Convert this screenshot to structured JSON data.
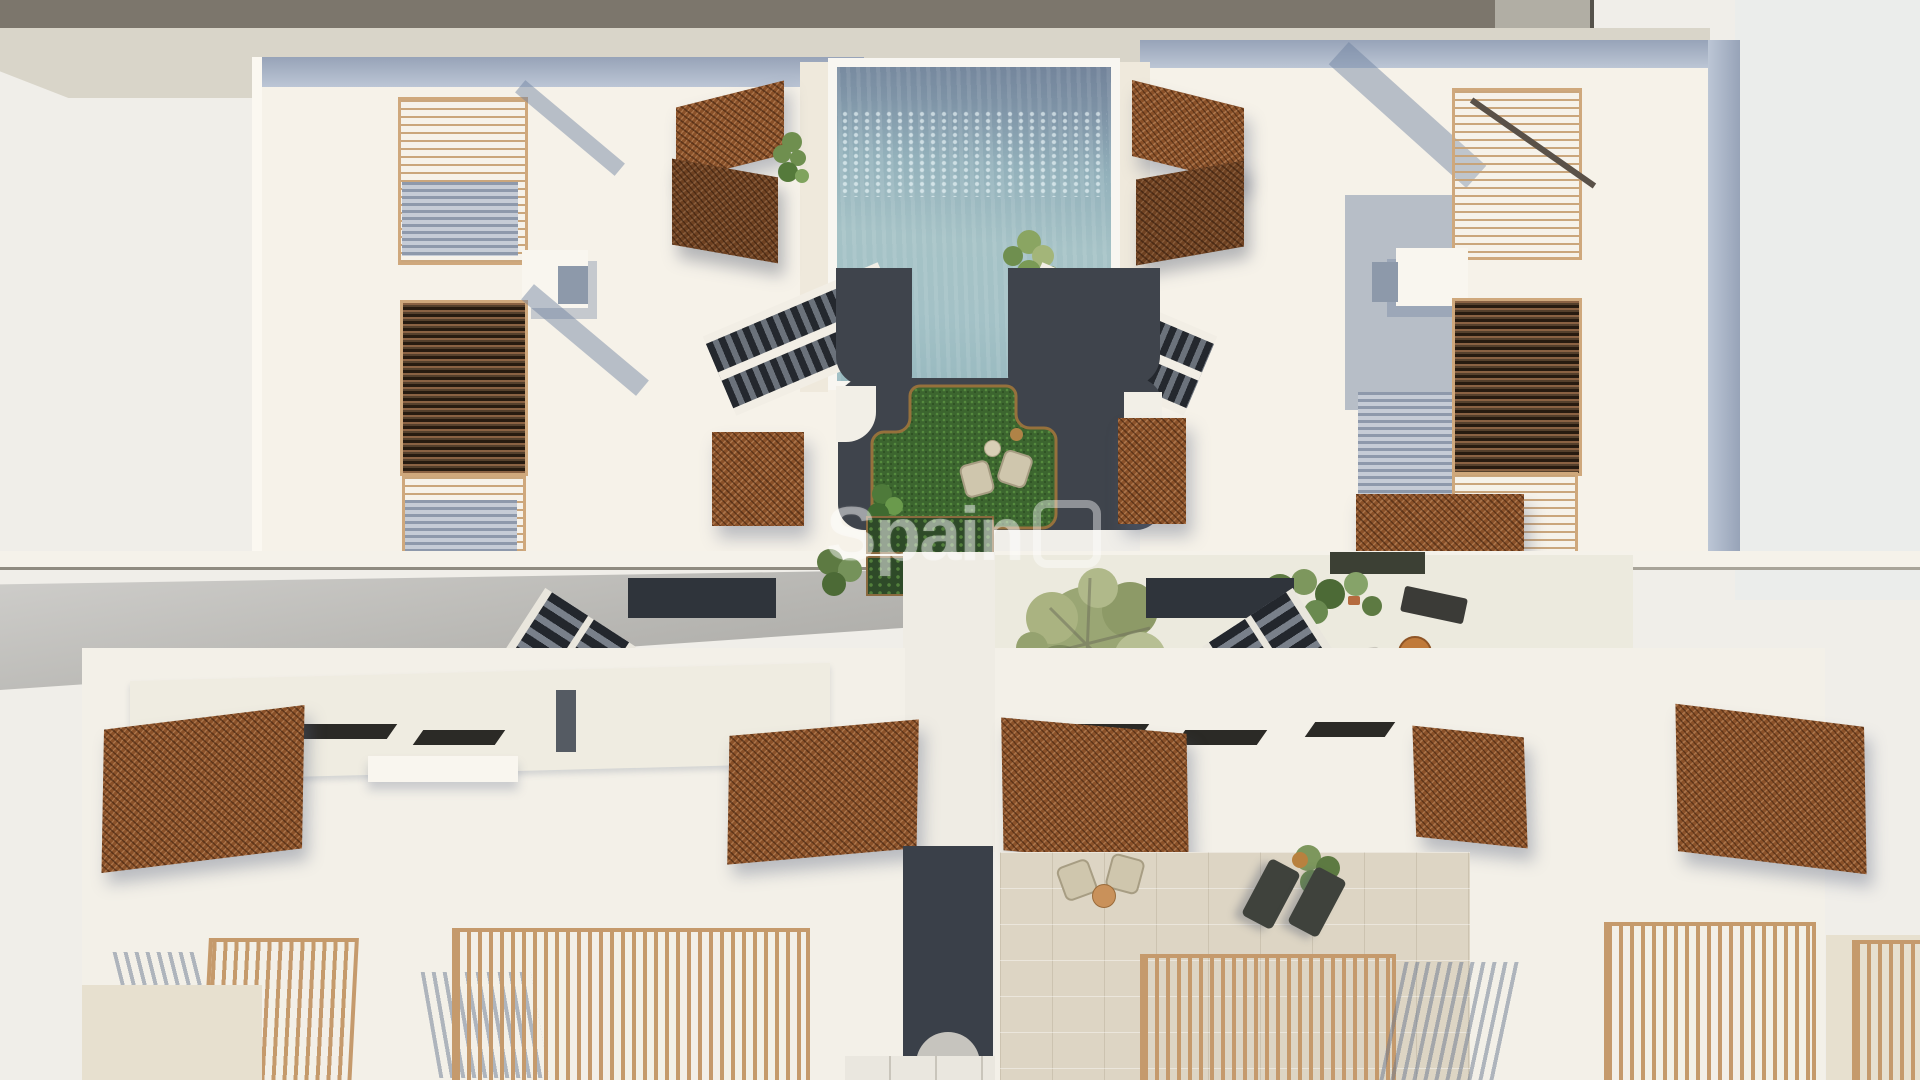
{
  "image": {
    "type": "architectural-aerial-render",
    "subject": "Top-down 3D render of a residential complex: two upper apartment blocks with slatted pergolas flanking a swimming pool, a sunken charcoal courtyard with a grass lounge area, twin stair ramps, a lower row of white-roofed townhouses with corten mesh canopies, wooden-slat terrace railings, olive tree and planted terraces, and a central dark walkway"
  },
  "watermark": {
    "text": "Spain",
    "color": "#ffffff",
    "opacity": "0.42"
  },
  "palette": {
    "background": "#f0eee9",
    "top_strip": "#7c766c",
    "sand_band": "#d9d5c9",
    "roof_cream": "#f6f2e9",
    "parapet_blue_gray": "#a9b3c4",
    "pool_deep": "#72839a",
    "pool_shallow": "#a5c2c6",
    "courtyard_charcoal": "#3f444c",
    "grass_green": "#3c652f",
    "grass_edge_bronze": "#96713c",
    "corten_rust": "#8a5129",
    "wood_tan": "#c59a6c",
    "wood_dark": "#3a2a1c",
    "walkway_navy": "#3a4049",
    "shadow_blue": "rgba(106,126,158,0.45)",
    "terrace_travertine": "#ddd5c4",
    "foliage_olive": "#9aa674",
    "foliage_dark": "#2e4a28"
  }
}
